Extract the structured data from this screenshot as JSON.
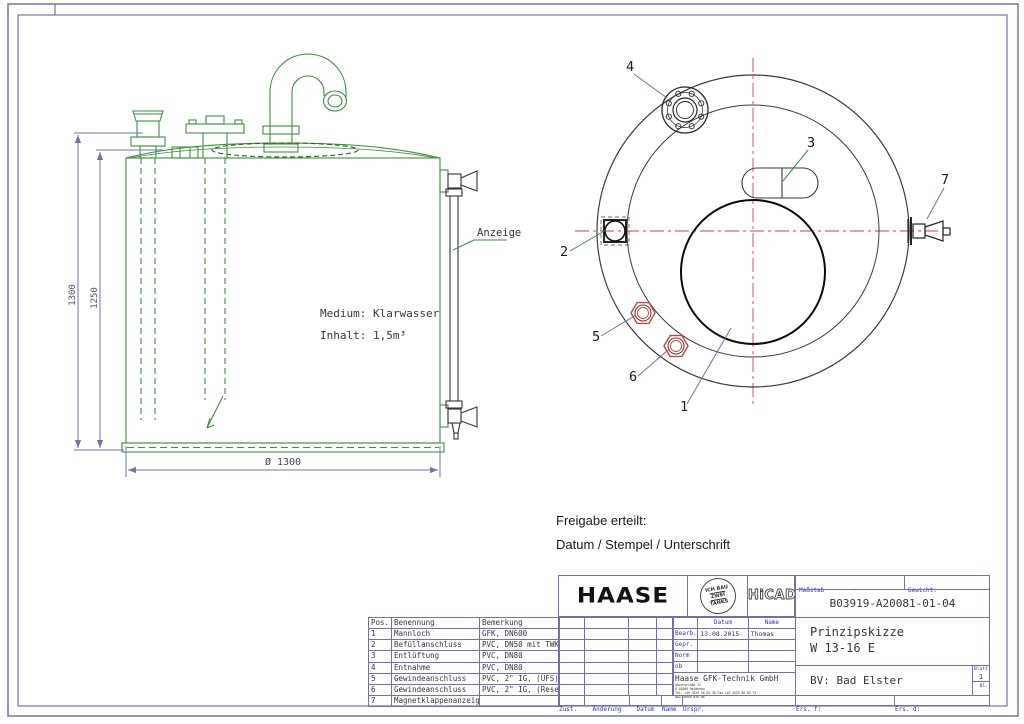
{
  "drawing": {
    "side_view": {
      "medium_label": "Medium: Klarwasser",
      "inhalt_label": "Inhalt: 1,5m³",
      "gauge_label": "Anzeige",
      "dim_total_height": "1300",
      "dim_body_height": "1250",
      "dim_diameter": "Ø 1300"
    },
    "top_view": {
      "callout_1": "1",
      "callout_2": "2",
      "callout_3": "3",
      "callout_4": "4",
      "callout_5": "5",
      "callout_6": "6",
      "callout_7": "7"
    },
    "release_note": {
      "line1": "Freigabe erteilt:",
      "line2": "Datum / Stempel / Unterschrift"
    }
  },
  "title_block": {
    "parts_list": {
      "headers": [
        "Pos.",
        "Benennung",
        "Bemerkung"
      ],
      "rows": [
        [
          "1",
          "Mannloch",
          "GFK, DN600"
        ],
        [
          "2",
          "Befüllanschluss",
          "PVC, DN50 mit TWK"
        ],
        [
          "3",
          "Entlüftung",
          "PVC, DN80"
        ],
        [
          "4",
          "Entnahme",
          "PVC, DN80"
        ],
        [
          "5",
          "Gewindeanschluss",
          "PVC, 2\" IG, (ÜFS)"
        ],
        [
          "6",
          "Gewindeanschluss",
          "PVC, 2\" IG, (Reserve)"
        ],
        [
          "7",
          "Magnetklappenanzeiger",
          ""
        ]
      ]
    },
    "logos": {
      "haase": "HAASE",
      "stamp_line1": "ICH BAU",
      "stamp_line2": "ZWEI",
      "stamp_line3": "TANKS",
      "hicad": "HiCAD"
    },
    "personnel": {
      "col_datum": "Datum",
      "col_name": "Name",
      "rows": [
        [
          "Bearb.",
          "13.08.2015",
          "Thomas"
        ],
        [
          "Gepr.",
          "",
          ""
        ],
        [
          "Norm",
          "",
          ""
        ],
        [
          "ob",
          "",
          ""
        ]
      ]
    },
    "company": {
      "name": "Haase GFK-Technik GmbH",
      "address": [
        "Ahornstraße 12",
        "D 01809 Heidenau",
        "Tel. +49 3529 56 05 38   Fax +49 3529 56 63 73",
        "www.haase-gfk.de"
      ]
    },
    "info": {
      "masstab_label": "Maßstab",
      "masstab_value": "–",
      "gewicht_label": "Gewicht:",
      "drawing_number": "B03919-A20081-01-04",
      "title_line1": "Prinzipskizze",
      "title_line2": "W 13-16 E",
      "bv": "BV: Bad Elster",
      "blatt_label": "Blatt",
      "blatt_value": "1",
      "bl_label": "Bl."
    },
    "revision_row": {
      "zust": "Zust.",
      "aenderung": "Änderung",
      "datum": "Datum",
      "name": "Name",
      "urspr": "Urspr.",
      "ers_f": "Ers. f:",
      "ers_d": "Ers. d:"
    }
  }
}
